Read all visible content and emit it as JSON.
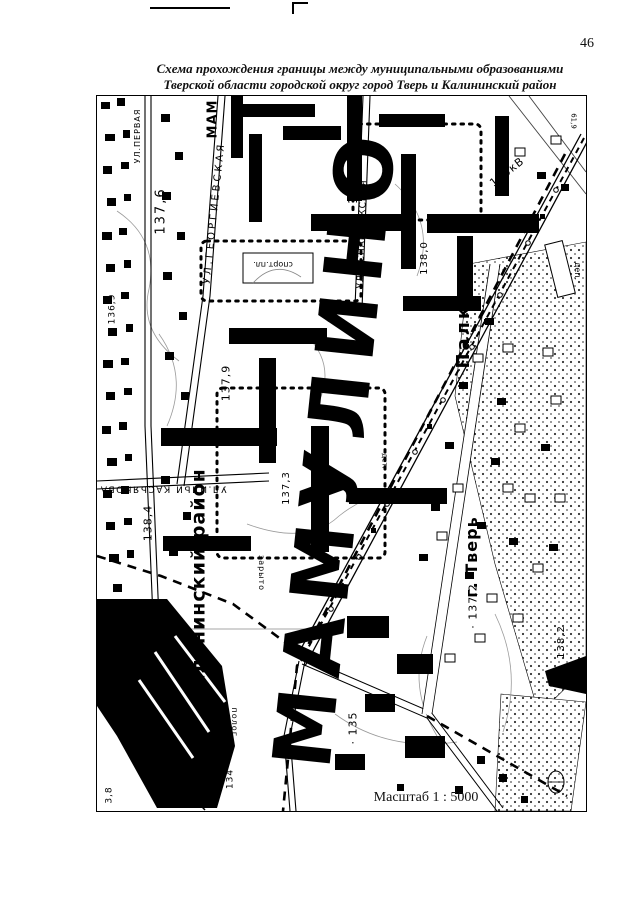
{
  "page": {
    "number": "46",
    "title_line1": "Схема прохождения границы между муниципальными образованиями",
    "title_line2": "Тверской области городской округ город Тверь и Калининский район"
  },
  "map": {
    "scale_label": "Масштаб 1 : 5000",
    "giant_label": "МАМУЛИНО",
    "labels": [
      {
        "id": "street-pervaya",
        "text": "УЛ.ПЕРВАЯ",
        "x": 137,
        "y": 135,
        "rot": -90,
        "size": 8,
        "ls": 1,
        "bold": false
      },
      {
        "id": "street-georgievskaya",
        "text": "УЛ.ГЕОРГИЕВСКАЯ",
        "x": 214,
        "y": 212,
        "rot": -84,
        "size": 10,
        "ls": 3,
        "bold": false
      },
      {
        "id": "street-osnabryukskaya",
        "text": "УЛ.ОСНАБРЮКСКАЯ",
        "x": 362,
        "y": 233,
        "rot": -88,
        "size": 9,
        "ls": 1,
        "bold": false
      },
      {
        "id": "street-ilyi-kasyanova",
        "text": "УЛ.ИЛЬИ КАСЬЯНОВА",
        "x": 162,
        "y": 487,
        "rot": 180,
        "size": 9,
        "ls": 1.5,
        "bold": false
      },
      {
        "id": "district-kalininsky",
        "text": "Калининский район",
        "x": 198,
        "y": 585,
        "rot": -90,
        "size": 19,
        "ls": 1,
        "bold": true
      },
      {
        "id": "city-tver",
        "text": "г. Тверь",
        "x": 471,
        "y": 556,
        "rot": -90,
        "size": 16,
        "ls": 1,
        "bold": true
      },
      {
        "id": "village-palkino",
        "text": "Палкино",
        "x": 463,
        "y": 312,
        "rot": -90,
        "size": 18,
        "ls": 3,
        "bold": true
      },
      {
        "id": "mam-fragment",
        "text": "МАМ",
        "x": 212,
        "y": 118,
        "rot": -90,
        "size": 13,
        "ls": 1,
        "bold": true
      },
      {
        "id": "powerline-110kv",
        "text": "110кВ",
        "x": 506,
        "y": 171,
        "rot": -38,
        "size": 11,
        "ls": 1,
        "bold": false
      },
      {
        "id": "sport-ground",
        "text": "спорт.пл.",
        "x": 272,
        "y": 263,
        "rot": 180,
        "size": 8,
        "ls": 0,
        "bold": false
      },
      {
        "id": "depot",
        "text": "деп.",
        "x": 576,
        "y": 270,
        "rot": 90,
        "size": 8,
        "ls": 0,
        "bold": false
      },
      {
        "id": "det",
        "text": "дет.",
        "x": 383,
        "y": 460,
        "rot": 90,
        "size": 7,
        "ls": 0,
        "bold": false
      },
      {
        "id": "zaryto",
        "text": "зарыто",
        "x": 260,
        "y": 572,
        "rot": 90,
        "size": 8,
        "ls": 1,
        "bold": false
      },
      {
        "id": "polog",
        "text": "полог.",
        "x": 233,
        "y": 723,
        "rot": 90,
        "size": 8,
        "ls": 1,
        "bold": false
      },
      {
        "id": "elev-137-6",
        "text": "137,6",
        "x": 160,
        "y": 210,
        "rot": -90,
        "size": 13,
        "ls": 2,
        "bold": false
      },
      {
        "id": "elev-136-9",
        "text": "136,9",
        "x": 112,
        "y": 308,
        "rot": -90,
        "size": 9,
        "ls": 1,
        "bold": false
      },
      {
        "id": "elev-137-9",
        "text": "137,9",
        "x": 225,
        "y": 382,
        "rot": -90,
        "size": 11,
        "ls": 1,
        "bold": false
      },
      {
        "id": "elev-139",
        "text": "139",
        "x": 352,
        "y": 190,
        "rot": -90,
        "size": 12,
        "ls": 1,
        "bold": false
      },
      {
        "id": "elev-138",
        "text": "138",
        "x": 331,
        "y": 310,
        "rot": -90,
        "size": 11,
        "ls": 1,
        "bold": false
      },
      {
        "id": "elev-138-0",
        "text": "138,0",
        "x": 424,
        "y": 257,
        "rot": -90,
        "size": 10,
        "ls": 1,
        "bold": false
      },
      {
        "id": "elev-138-4",
        "text": "138,4",
        "x": 147,
        "y": 522,
        "rot": -90,
        "size": 11,
        "ls": 1,
        "bold": false
      },
      {
        "id": "elev-137-3",
        "text": "137,3",
        "x": 286,
        "y": 487,
        "rot": -90,
        "size": 10,
        "ls": 1,
        "bold": false
      },
      {
        "id": "elev-137-2",
        "text": "· 137,2",
        "x": 472,
        "y": 605,
        "rot": -90,
        "size": 11,
        "ls": 1,
        "bold": false
      },
      {
        "id": "elev-138-2",
        "text": "138,2",
        "x": 561,
        "y": 641,
        "rot": -90,
        "size": 10,
        "ls": 1,
        "bold": false
      },
      {
        "id": "elev-135",
        "text": "· 135",
        "x": 352,
        "y": 727,
        "rot": -90,
        "size": 11,
        "ls": 1,
        "bold": false
      },
      {
        "id": "elev-134",
        "text": "134",
        "x": 230,
        "y": 778,
        "rot": -90,
        "size": 9,
        "ls": 1,
        "bold": false
      },
      {
        "id": "elev-3-8",
        "text": "3,8",
        "x": 109,
        "y": 794,
        "rot": -90,
        "size": 9,
        "ls": 1,
        "bold": false
      },
      {
        "id": "elev-61-9",
        "text": "61,9",
        "x": 572,
        "y": 120,
        "rot": 90,
        "size": 7,
        "ls": 0,
        "bold": false
      }
    ]
  }
}
